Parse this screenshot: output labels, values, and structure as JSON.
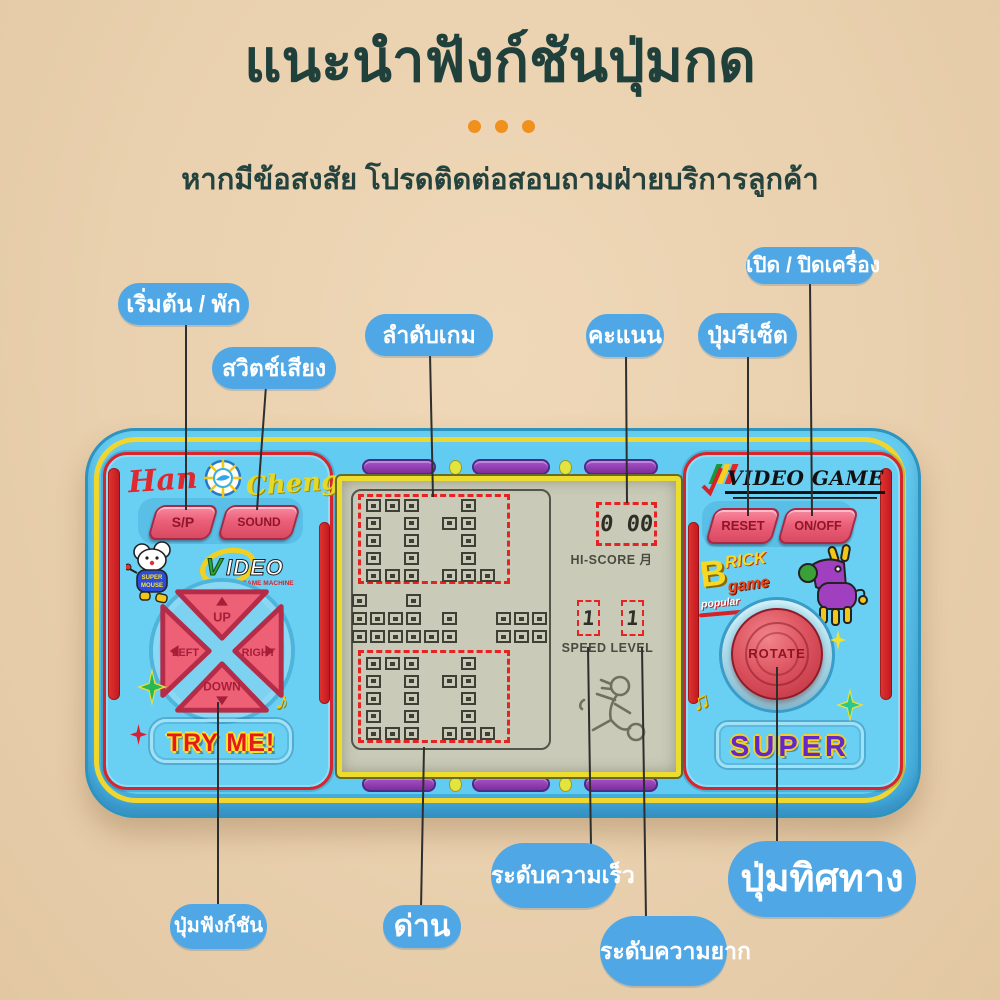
{
  "page": {
    "title": "แนะนำฟังก์ชันปุ่มกด",
    "subtitle": "หากมีข้อสงสัย โปรดติดต่อสอบถามฝ่ายบริการลูกค้า"
  },
  "colors": {
    "background": "#e9d0ae",
    "title_text": "#20403c",
    "callout_blue": "#4fa8e5",
    "console_blue": "#62cbf1",
    "trim_yellow": "#f0d62e",
    "accent_red": "#d6252c",
    "button_pink": "#ec5f78",
    "screen_lcd": "#c9cbb8",
    "deco_purple": "#9334b4",
    "dots_orange": "#f0911e"
  },
  "callouts": {
    "start_pause": "เริ่มต้น / พัก",
    "sound_switch": "สวิตช์เสียง",
    "game_order": "ลำดับเกม",
    "score": "คะแนน",
    "reset_button": "ปุ่มรีเซ็ต",
    "power": "เปิด / ปิดเครื่อง",
    "function_button": "ปุ่มฟังก์ชัน",
    "stage": "ด่าน",
    "speed_level": "ระดับความเร็ว",
    "difficulty_level": "ระดับความยาก",
    "direction_button": "ปุ่มทิศทาง"
  },
  "console": {
    "brand_left_1": "Han",
    "brand_left_2": "Cheng",
    "brand_right": "VIDEO GAME",
    "video_logo": "VIDEO",
    "video_logo_sub": "GAME MACHINE",
    "mouse_text_1": "SUPER",
    "mouse_text_2": "MOUSE",
    "brick_logo": {
      "b": "B",
      "rick": "RICK",
      "game": "game",
      "popular": "popular"
    },
    "buttons": {
      "sp": "S/P",
      "sound": "SOUND",
      "reset": "RESET",
      "onoff": "ON/OFF",
      "rotate": "ROTATE"
    },
    "dpad": {
      "up": "UP",
      "down": "DOWN",
      "left": "LEFT",
      "right": "RIGHT"
    },
    "try_me": "TRY ME!",
    "super_label": "SUPER",
    "screen": {
      "hi_score_label": "HI-SCORE 月",
      "score_value": "0 00",
      "speed_label": "SPEED LEVEL",
      "speed_digits": [
        "1",
        "1"
      ],
      "level_value_top": "01",
      "level_value_bottom": "01",
      "digit_zero": [
        "111",
        "101",
        "101",
        "101",
        "111"
      ],
      "digit_one": [
        "010",
        "110",
        "010",
        "010",
        "111"
      ],
      "pile": [
        "1..1.......",
        "1111.1..111",
        "111111..111"
      ]
    }
  }
}
